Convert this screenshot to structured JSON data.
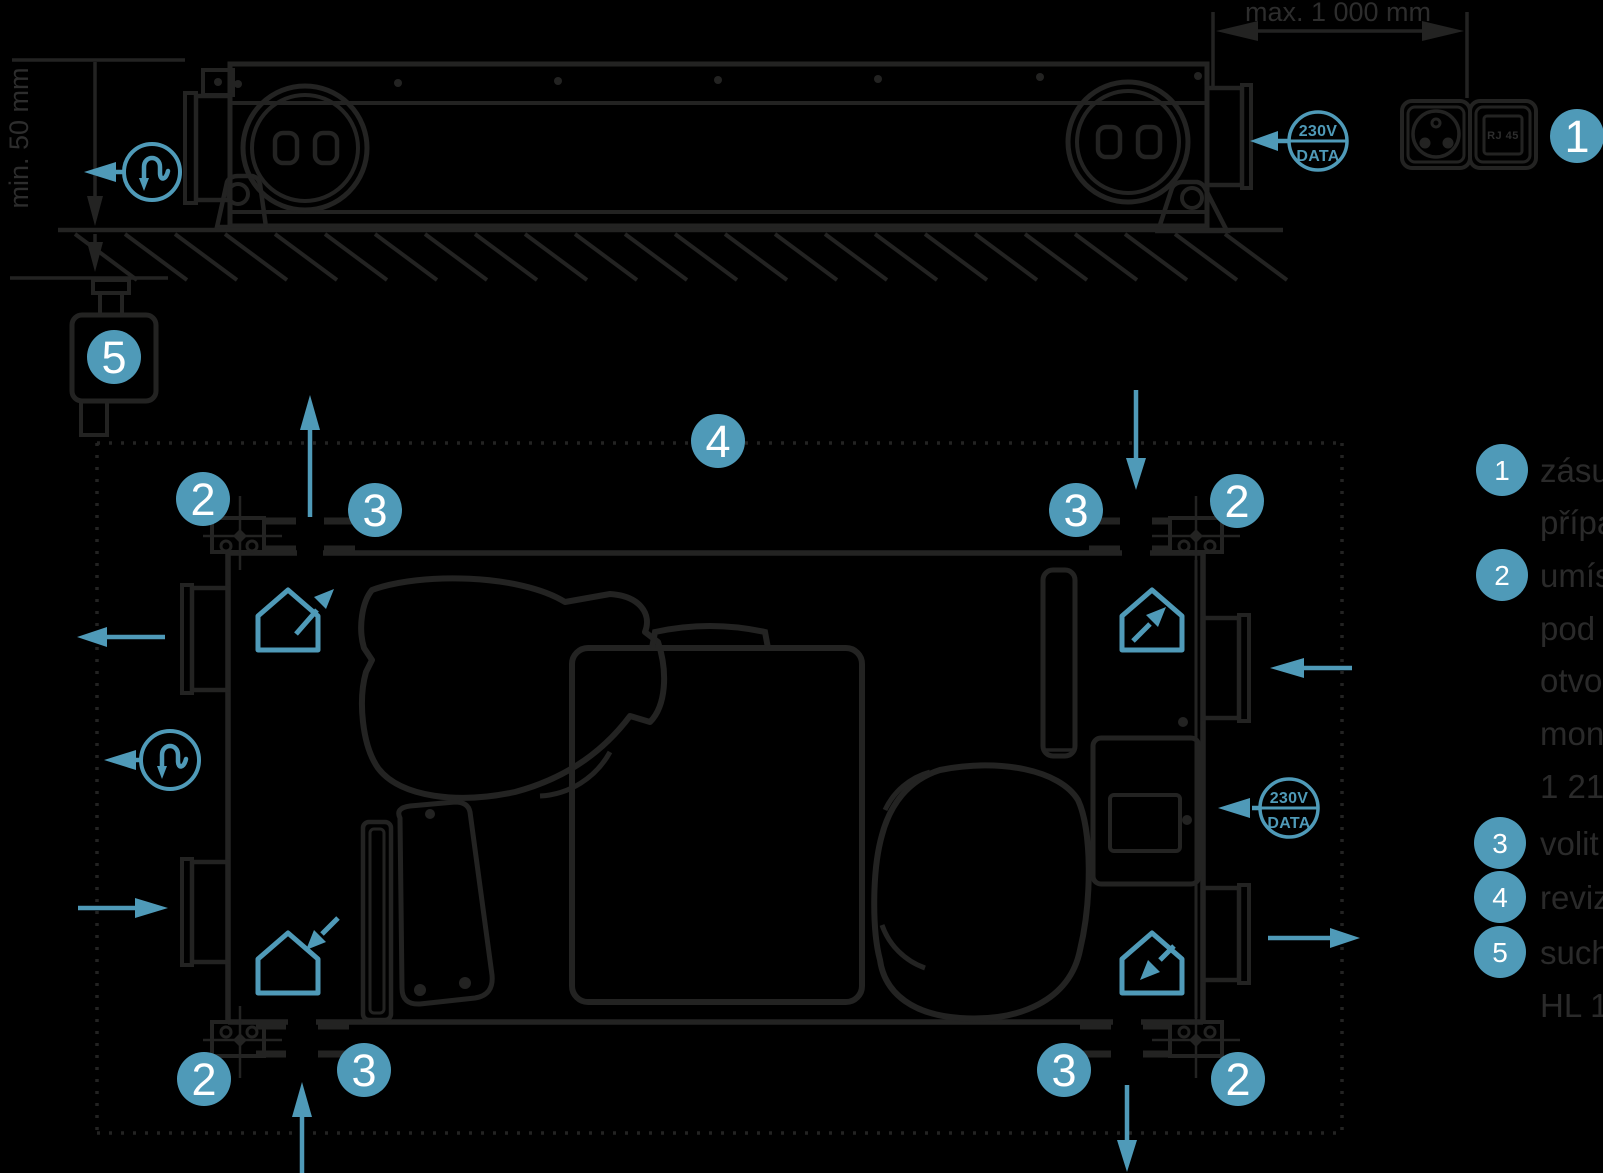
{
  "colors": {
    "background": "#000000",
    "accent": "#4f9ab8",
    "line": "#232322",
    "dim_text": "#2d2d2d",
    "legend_text": "#2a2a2a",
    "callout_text": "#ffffff"
  },
  "dimensions": {
    "max_width": "max. 1 000 mm",
    "min_clearance": "min. 50 mm"
  },
  "power_data_badge": {
    "line1": "230V",
    "line2": "DATA"
  },
  "wall_outlet": {
    "rj45_label": "RJ 45"
  },
  "callouts": {
    "outlet": "1",
    "bracket": "2",
    "port": "3",
    "inspection": "4",
    "siphon": "5"
  },
  "legend": {
    "items": [
      {
        "number": "1",
        "lines": [
          "zásu",
          "přípa"
        ]
      },
      {
        "number": "2",
        "lines": [
          "umís",
          "pod",
          "otvo",
          "mon",
          "1 21"
        ]
      },
      {
        "number": "3",
        "lines": [
          "volit"
        ]
      },
      {
        "number": "4",
        "lines": [
          "reviz"
        ]
      },
      {
        "number": "5",
        "lines": [
          "such",
          "HL 1"
        ]
      }
    ]
  }
}
